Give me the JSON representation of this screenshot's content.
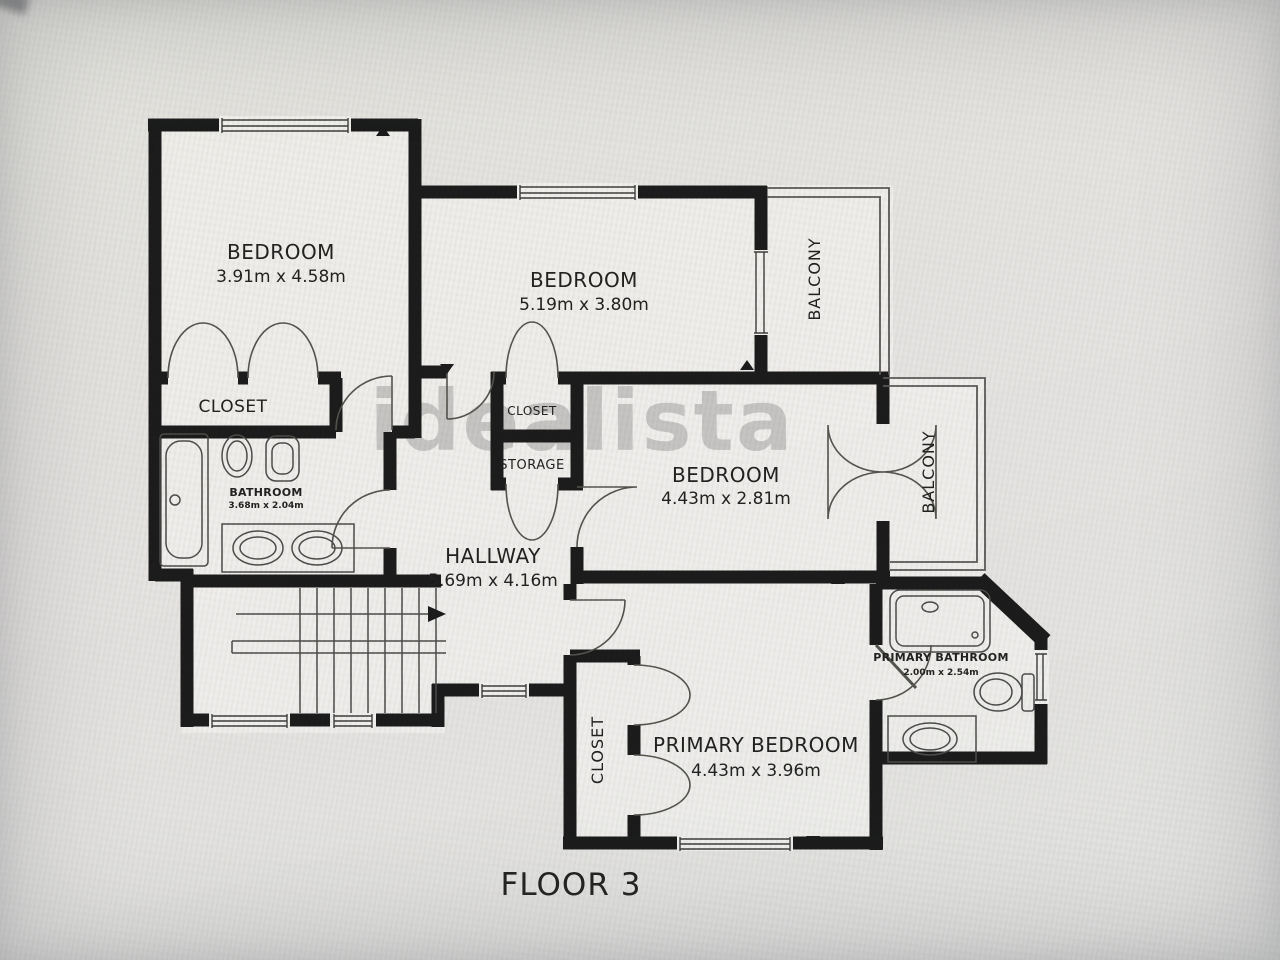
{
  "floor_label": "FLOOR 3",
  "watermark": "idealista",
  "colors": {
    "wall": "#1c1c1c",
    "floor": "#f2f1ee",
    "thin_line": "#4d4d4d",
    "background": "#e8e7e4",
    "watermark_gray": "#8f8f8f"
  },
  "rooms": {
    "bedroom1": {
      "name": "BEDROOM",
      "dims": "3.91m x 4.58m"
    },
    "bedroom2": {
      "name": "BEDROOM",
      "dims": "5.19m x 3.80m"
    },
    "bedroom3": {
      "name": "BEDROOM",
      "dims": "4.43m x 2.81m"
    },
    "primary_bedroom": {
      "name": "PRIMARY BEDROOM",
      "dims": "4.43m x 3.96m"
    },
    "hallway": {
      "name": "HALLWAY",
      "dims": "5.69m x 4.16m"
    },
    "bathroom": {
      "name": "BATHROOM",
      "dims": "3.68m x 2.04m"
    },
    "primary_bathroom": {
      "name": "PRIMARY BATHROOM",
      "dims": "2.00m x 2.54m"
    },
    "closet1": {
      "name": "CLOSET"
    },
    "closet2": {
      "name": "CLOSET"
    },
    "storage": {
      "name": "STORAGE"
    },
    "primary_closet": {
      "name": "CLOSET"
    },
    "balcony1": {
      "name": "BALCONY"
    },
    "balcony2": {
      "name": "BALCONY"
    }
  }
}
